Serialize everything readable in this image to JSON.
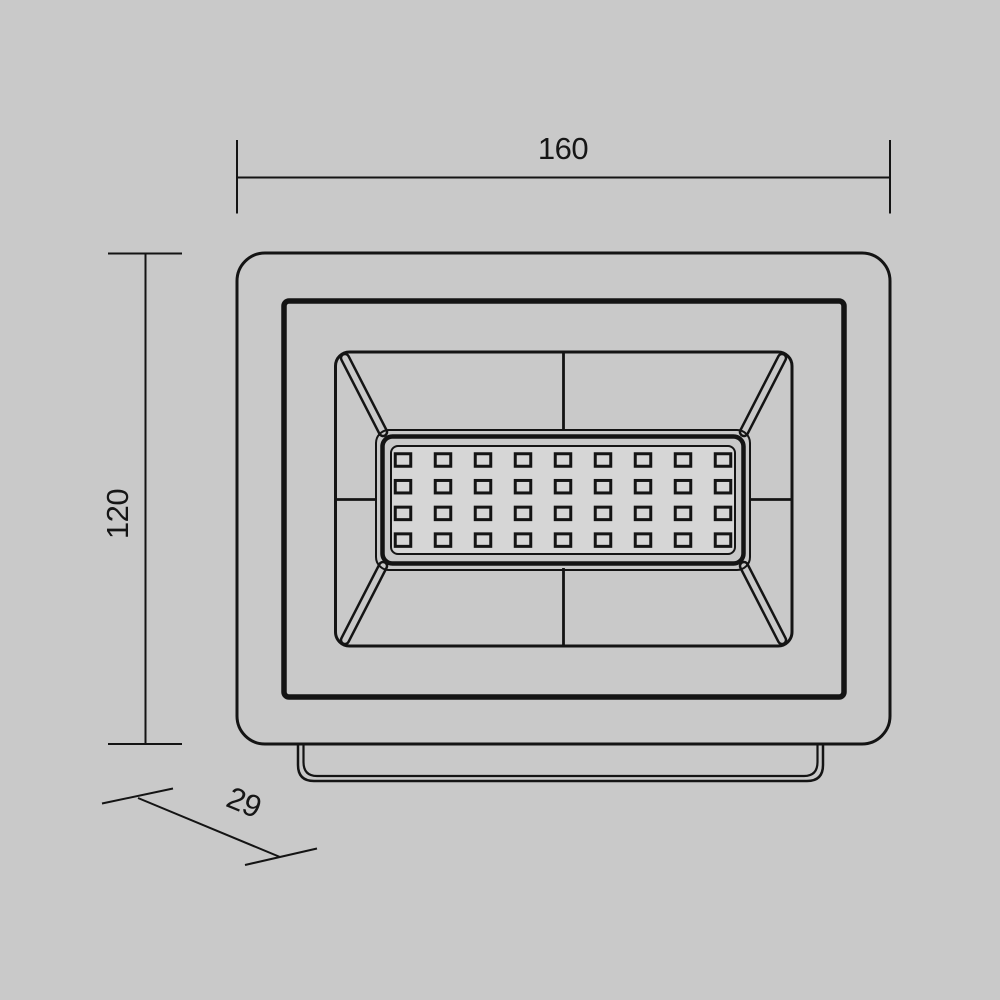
{
  "drawing": {
    "dim_width_label": "160",
    "dim_height_label": "120",
    "dim_depth_label": "29",
    "led_grid": {
      "rows": 4,
      "cols": 9
    }
  },
  "colors": {
    "background": "#c9c9c9",
    "line": "#141414",
    "panel_fill": "#d6d6d6",
    "text": "#161616"
  }
}
